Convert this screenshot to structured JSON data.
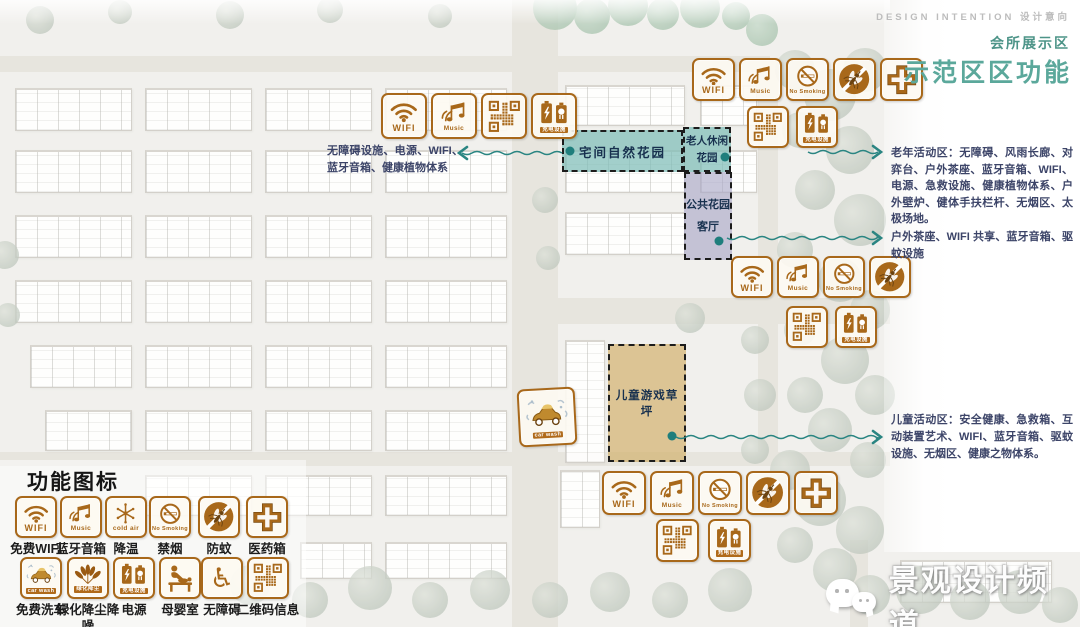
{
  "header": {
    "design_intention": "DESIGN INTENTION  设计意向",
    "subtitle": "会所展示区",
    "title": "示范区区功能"
  },
  "zones": {
    "home_garden": {
      "label": "宅间自然花园"
    },
    "elderly_garden": {
      "label": "老人休闲花园"
    },
    "public_garden": {
      "label": "公共花园客厅"
    },
    "children_lawn": {
      "label": "儿童游戏草坪"
    }
  },
  "annotations": {
    "left": "无障碍设施、电源、WIFI、蓝牙音箱、健康植物体系",
    "elderly": "老年活动区：无障碍、风雨长廊、对弈台、户外茶座、蓝牙音箱、WIFI、电源、急救设施、健康植物体系、户外壁炉、健体手扶栏杆、无烟区、太极场地。",
    "tea": "户外茶座、WIFI 共享、蓝牙音箱、驱蚊设施",
    "children": "儿童活动区：安全健康、急救箱、互动装置艺术、WIFI、蓝牙音箱、驱蚊设施、无烟区、健康之物体系。"
  },
  "icon_defs": {
    "wifi": {
      "icon": "wifi-icon",
      "label": "WIFI"
    },
    "music": {
      "icon": "music-icon",
      "label": "Music"
    },
    "no_smoking": {
      "icon": "no-smoking-icon",
      "label": "No Smoking"
    },
    "mosquito": {
      "icon": "mosquito-repellent-icon",
      "label": ""
    },
    "medical": {
      "icon": "medical-cross-icon",
      "label": ""
    },
    "qr": {
      "icon": "qr-code-icon",
      "label": ""
    },
    "battery": {
      "icon": "charging-battery-icon",
      "label": "充电设施"
    },
    "cold_air": {
      "icon": "cold-air-snowflake-icon",
      "label": "cold air"
    },
    "car_wash": {
      "icon": "car-wash-icon",
      "label": "car wash"
    },
    "leaves": {
      "icon": "greenery-leaves-icon",
      "label": "绿化降尘"
    },
    "mother_baby": {
      "icon": "mother-baby-room-icon",
      "label": ""
    },
    "wheelchair": {
      "icon": "wheelchair-accessible-icon",
      "label": ""
    }
  },
  "icon_groups": {
    "left_row": [
      "wifi",
      "music",
      "qr",
      "battery"
    ],
    "top_right_row1": [
      "wifi",
      "music",
      "no_smoking",
      "mosquito",
      "medical"
    ],
    "top_right_row2": [
      "qr",
      "battery"
    ],
    "mid_right_row1": [
      "wifi",
      "music",
      "no_smoking",
      "mosquito"
    ],
    "mid_right_row2": [
      "qr",
      "battery"
    ],
    "bottom_row1": [
      "wifi",
      "music",
      "no_smoking",
      "mosquito",
      "medical"
    ],
    "bottom_row2": [
      "qr",
      "battery"
    ],
    "car_wash_badge": [
      "car_wash"
    ]
  },
  "legend": {
    "title": "功能图标",
    "rows": [
      [
        {
          "icon": "wifi",
          "label": "免费WIFI"
        },
        {
          "icon": "music",
          "label": "蓝牙音箱"
        },
        {
          "icon": "cold_air",
          "label": "降温"
        },
        {
          "icon": "no_smoking",
          "label": "禁烟"
        },
        {
          "icon": "mosquito",
          "label": "防蚊"
        },
        {
          "icon": "medical",
          "label": "医药箱"
        }
      ],
      [
        {
          "icon": "car_wash",
          "label": "免费洗车"
        },
        {
          "icon": "leaves",
          "label": "绿化降尘降噪"
        },
        {
          "icon": "battery",
          "label": "电源"
        },
        {
          "icon": "mother_baby",
          "label": "母婴室"
        },
        {
          "icon": "wheelchair",
          "label": "无障碍"
        },
        {
          "icon": "qr",
          "label": "二维码信息"
        }
      ]
    ]
  },
  "watermark": {
    "text": "景观设计频道"
  },
  "colors": {
    "accent_orange": "#a8681a",
    "connector_teal": "#2a8582",
    "heading_teal": "#5ba89b",
    "subtitle_teal": "#4d9488",
    "zone_teal": "#7ebcb7",
    "zone_purple": "#a8a6c7",
    "zone_tan": "#d2b06a",
    "annotation_navy": "#3c4468"
  }
}
